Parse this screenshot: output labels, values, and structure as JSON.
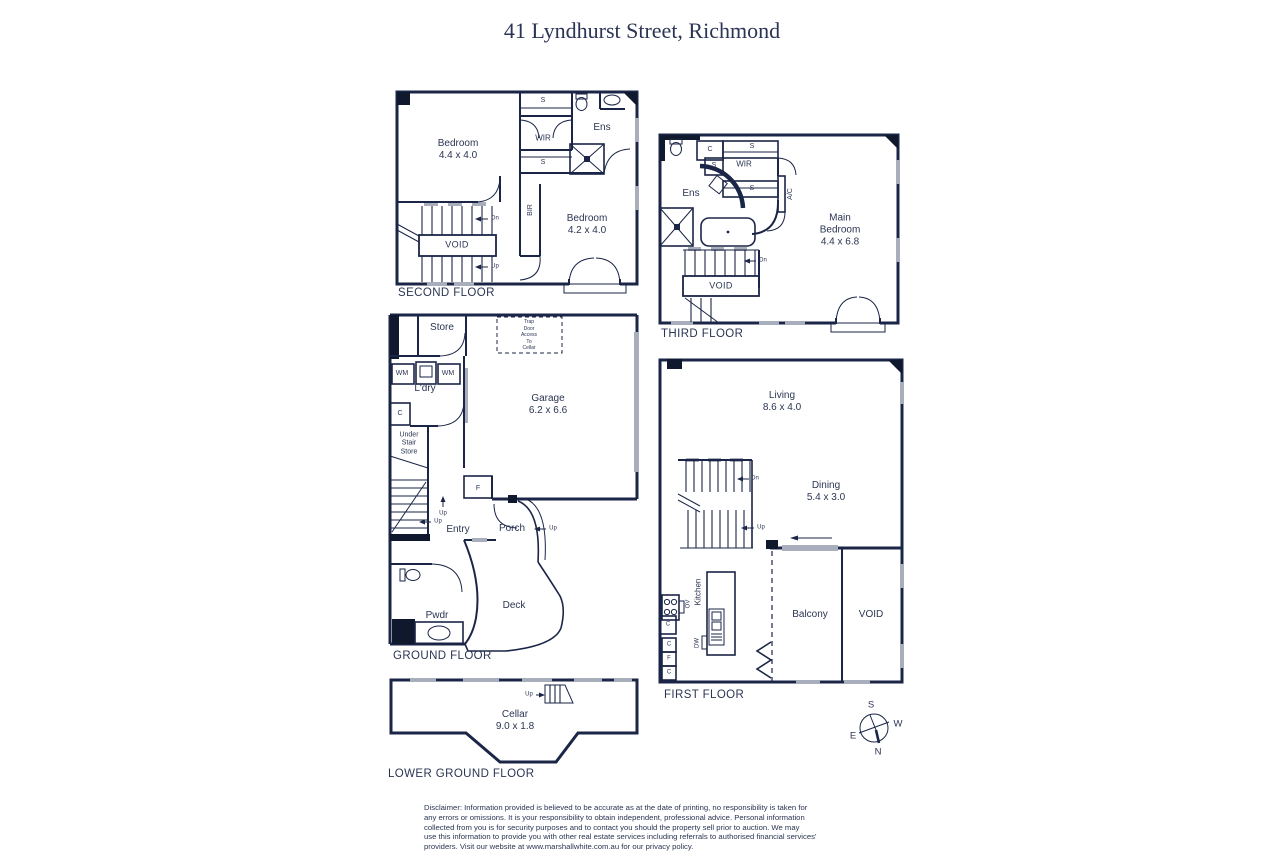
{
  "title": "41 Lyndhurst Street, Richmond",
  "floors": {
    "second": {
      "name": "SECOND FLOOR",
      "labels": {
        "bedroom1": "Bedroom\n4.4 x 4.0",
        "wir": "WIR",
        "ens": "Ens",
        "s_top": "S",
        "s_bottom": "S",
        "bir": "BIR",
        "bedroom2": "Bedroom\n4.2 x 4.0",
        "void": "VOID",
        "dn": "Dn",
        "up": "Up"
      }
    },
    "third": {
      "name": "THIRD FLOOR",
      "labels": {
        "ens": "Ens",
        "c": "C",
        "s1": "S",
        "s2": "S",
        "s3": "S",
        "wir": "WIR",
        "ac": "A/C",
        "main_bedroom": "Main\nBedroom\n4.4 x 6.8",
        "void": "VOID",
        "dn": "Dn"
      }
    },
    "ground": {
      "name": "GROUND FLOOR",
      "labels": {
        "store": "Store",
        "trap_door": "Trap\nDoor\nAccess\nTo\nCellar",
        "wm1": "WM",
        "wm2": "WM",
        "ldry": "L'dry",
        "c": "C",
        "under_stair": "Under\nStair\nStore",
        "garage": "Garage\n6.2 x 6.6",
        "f": "F",
        "entry": "Entry",
        "porch": "Porch",
        "deck": "Deck",
        "pwdr": "Pwdr",
        "up1": "Up",
        "up2": "Up",
        "up3": "Up"
      }
    },
    "first": {
      "name": "FIRST FLOOR",
      "labels": {
        "living": "Living\n8.6 x 4.0",
        "dining": "Dining\n5.4 x 3.0",
        "kitchen": "Kitchen",
        "ov": "OV",
        "dw": "DW",
        "c1": "C",
        "c2": "C",
        "f": "F",
        "c3": "C",
        "balcony": "Balcony",
        "void": "VOID",
        "dn": "Dn",
        "up": "Up"
      }
    },
    "lower": {
      "name": "LOWER GROUND FLOOR",
      "labels": {
        "cellar": "Cellar\n9.0 x 1.8",
        "up": "Up"
      }
    }
  },
  "compass": {
    "n": "N",
    "s": "S",
    "e": "E",
    "w": "W"
  },
  "disclaimer": "Disclaimer: Information provided is believed to be accurate as at the date of printing, no responsibility is taken for\nany errors or omissions. It is your responsibility to obtain independent, professional advice. Personal information\ncollected from you is for security purposes and to contact you should the property sell prior to auction. We may\nuse this information to provide you with other real estate services including referrals to authorised financial services'\nproviders. Visit our website at www.marshallwhite.com.au for our privacy policy.",
  "colors": {
    "wall": "#1b2547",
    "text": "#2b3553",
    "window_mark": "#a9aebc"
  }
}
